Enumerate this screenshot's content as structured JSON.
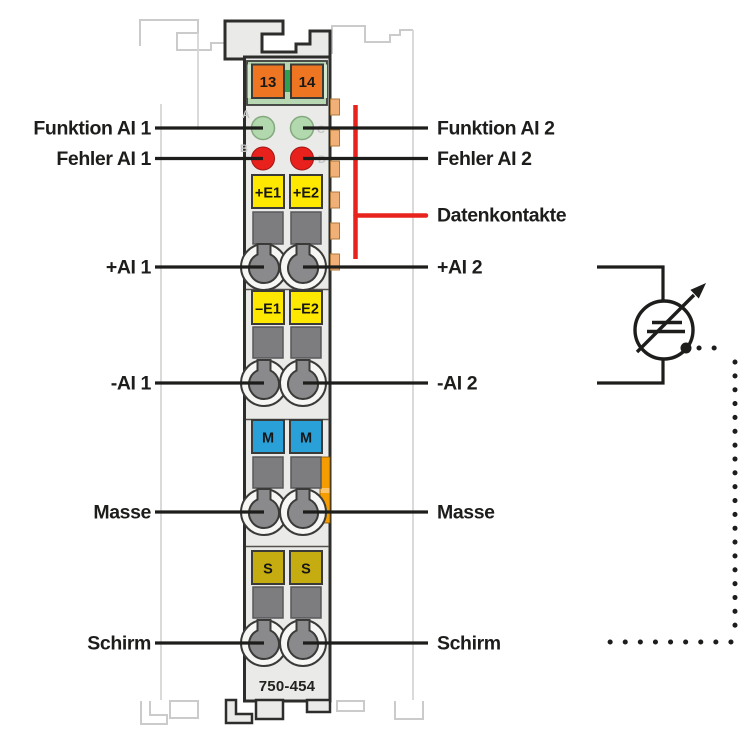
{
  "module": {
    "model": "750-454",
    "power_contact_left": "13",
    "power_contact_right": "14",
    "led_a": "A",
    "led_b": "B",
    "led_c": "C",
    "led_d": "D",
    "sq_plus_e1": "+E1",
    "sq_plus_e2": "+E2",
    "sq_minus_e1": "–E1",
    "sq_minus_e2": "–E2",
    "sq_m1": "M",
    "sq_m2": "M",
    "sq_s1": "S",
    "sq_s2": "S"
  },
  "labels_left": [
    "Funktion AI 1",
    "Fehler AI 1",
    "+AI 1",
    "-AI 1",
    "Masse",
    "Schirm"
  ],
  "labels_right": [
    "Funktion AI 2",
    "Fehler AI 2",
    "Datenkontakte",
    "+AI 2",
    "-AI 2",
    "Masse",
    "Schirm"
  ],
  "colors": {
    "module_body": "#eaeae8",
    "outline": "#2d2d2b",
    "power_jumper_orange": "#ee7622",
    "panel_green": "#b7d8b2",
    "connector_green": "#2fa14e",
    "led_green": "#b2d8ad",
    "led_red": "#e8211d",
    "signal_yellow": "#ffe800",
    "ground_blue": "#2aa0d8",
    "shield_olive": "#c5ac10",
    "clamp_gray": "#7d7d80",
    "data_contact_tan": "#f0b078",
    "latch_orange": "#f59d00",
    "marker_red": "#e8231e",
    "ghost_gray": "#cbcbcb",
    "line_black": "#1d1d1b"
  }
}
